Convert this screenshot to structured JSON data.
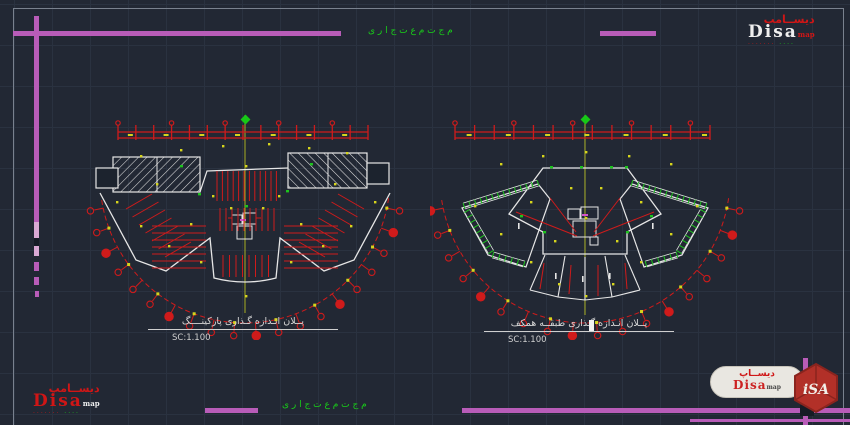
{
  "canvas": {
    "bg": "#222834",
    "grid": "#2a3240"
  },
  "colors": {
    "red": "#cf1b1b",
    "green": "#1dc41d",
    "yellow": "#d6d51d",
    "white": "#e6e6e6",
    "magenta": "#b85cb8",
    "centerline": "#a8ae22",
    "corepink": "#d254cc"
  },
  "notes": {
    "top": "م ج ت م ع  ت ج ا ر ی",
    "bottom": "م ج ت م ع  ت ج ا ر ی"
  },
  "plans": [
    {
      "id": "parking",
      "title": "پــلان انـدازه گـذاری پارکینــــگ",
      "scale_label": "SC:1.100"
    },
    {
      "id": "ground-floor",
      "title": "پــلان انـدازه گـذاری طبقــه همکف",
      "scale_label": "SC:1.100"
    }
  ],
  "logos": {
    "top_right": {
      "arabic": "دیســامپ",
      "latin": "Disa",
      "suffix": "map",
      "dots_red": "·······",
      "dots_green": "····"
    },
    "bottom_left": {
      "arabic": "دیســامپ",
      "latin": "Disa",
      "suffix": "map",
      "dots_red": "·······",
      "dots_green": "····"
    },
    "bottom_right": {
      "arabic": "دیســاپ",
      "latin": "Disa",
      "suffix": "map",
      "mark": "iSA"
    }
  },
  "drawing": {
    "left": {
      "cx": 165,
      "cy": 73,
      "r": 145,
      "a0": 8,
      "a1": 172,
      "bubbles": 20,
      "dimX0": 38,
      "dimX1": 288,
      "dimY": 27,
      "dim_ticks": 15,
      "dots": [
        [
          60,
          50
        ],
        [
          100,
          44
        ],
        [
          142,
          40
        ],
        [
          188,
          38
        ],
        [
          228,
          42
        ],
        [
          266,
          47
        ],
        [
          36,
          96
        ],
        [
          60,
          120
        ],
        [
          88,
          140
        ],
        [
          120,
          156
        ],
        [
          165,
          190
        ],
        [
          210,
          156
        ],
        [
          242,
          140
        ],
        [
          270,
          120
        ],
        [
          294,
          96
        ],
        [
          150,
          102
        ],
        [
          182,
          102
        ],
        [
          76,
          78
        ],
        [
          254,
          78
        ],
        [
          110,
          118
        ],
        [
          220,
          118
        ],
        [
          165,
          60
        ],
        [
          132,
          90
        ],
        [
          198,
          90
        ]
      ],
      "greens": [
        [
          118,
          88
        ],
        [
          206,
          85
        ],
        [
          100,
          60
        ],
        [
          230,
          58
        ],
        [
          165,
          100
        ]
      ]
    },
    "right": {
      "cx": 155,
      "cy": 73,
      "r": 145,
      "a0": 8,
      "a1": 172,
      "bubbles": 18,
      "dimX0": 25,
      "dimX1": 280,
      "dimY": 27,
      "dim_ticks": 14,
      "dots": [
        [
          70,
          58
        ],
        [
          112,
          50
        ],
        [
          155,
          46
        ],
        [
          198,
          50
        ],
        [
          240,
          58
        ],
        [
          44,
          100
        ],
        [
          70,
          128
        ],
        [
          100,
          156
        ],
        [
          128,
          178
        ],
        [
          155,
          190
        ],
        [
          182,
          178
        ],
        [
          210,
          156
        ],
        [
          240,
          128
        ],
        [
          266,
          100
        ],
        [
          140,
          82
        ],
        [
          170,
          82
        ],
        [
          155,
          112
        ],
        [
          100,
          96
        ],
        [
          210,
          96
        ],
        [
          124,
          135
        ],
        [
          186,
          135
        ]
      ],
      "greens": [
        [
          120,
          61
        ],
        [
          150,
          61
        ],
        [
          180,
          61
        ],
        [
          195,
          61
        ],
        [
          113,
          126
        ],
        [
          196,
          126
        ],
        [
          90,
          110
        ],
        [
          220,
          110
        ]
      ]
    }
  }
}
